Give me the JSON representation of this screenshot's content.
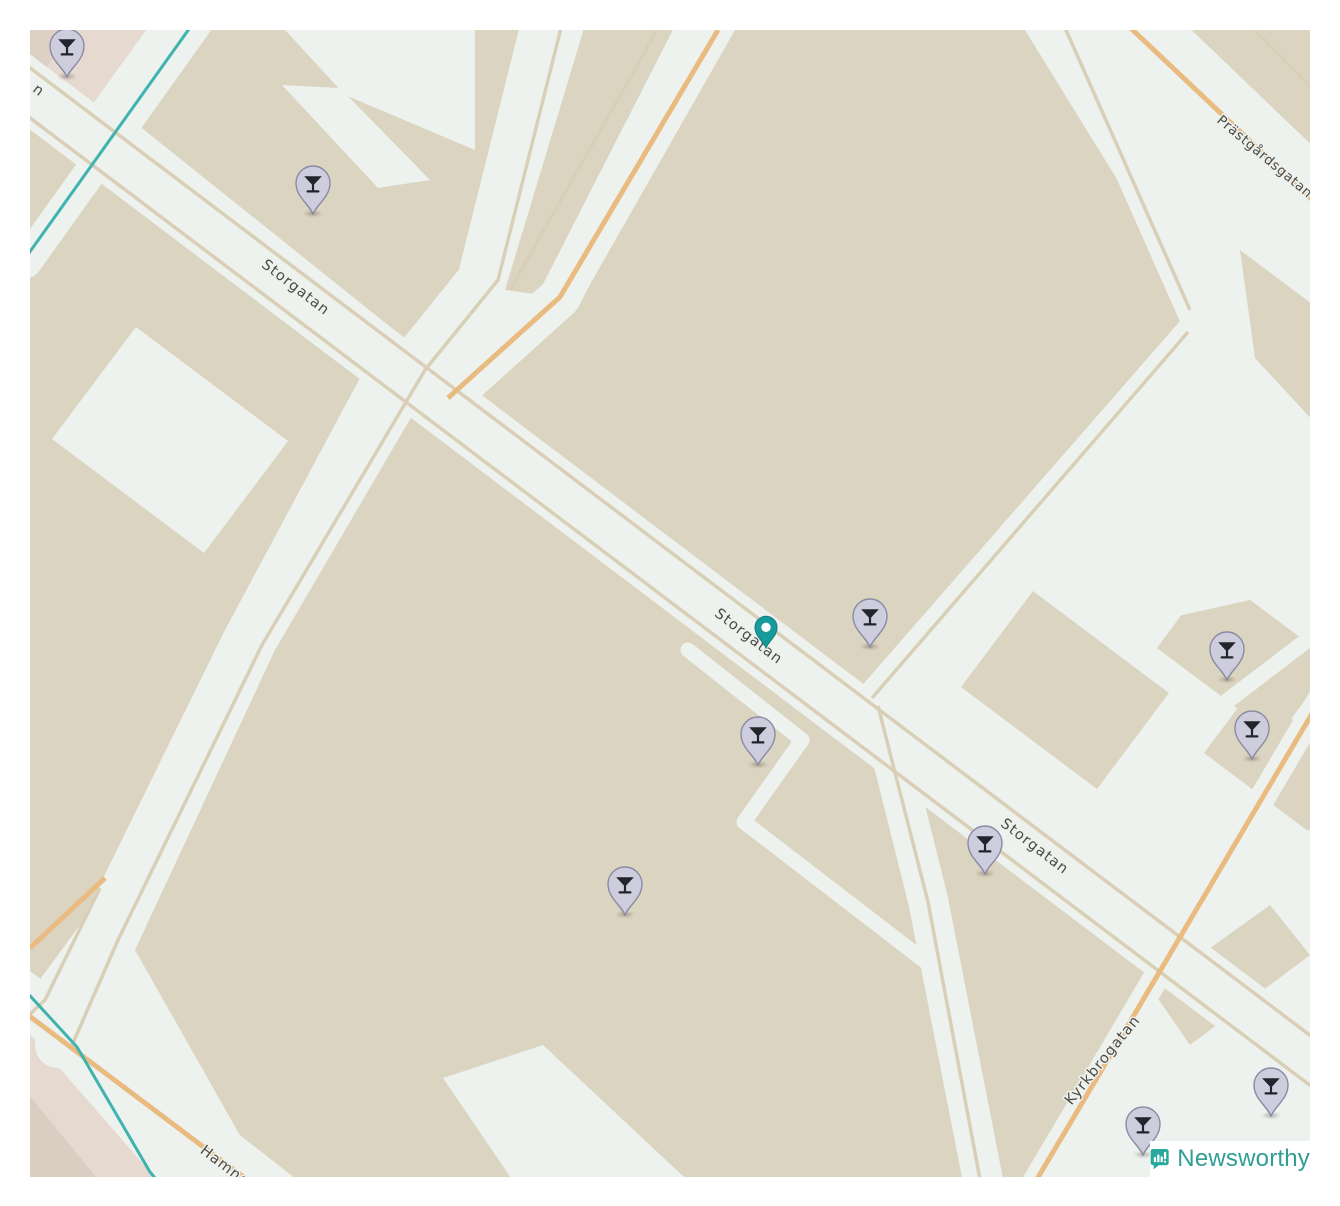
{
  "attribution": {
    "brand": "Newsworthy",
    "logo_icon": "bar-chart-speech-bubble-icon",
    "brand_color": "#2f9e95"
  },
  "map": {
    "street_labels": [
      {
        "name": "storgatan-northwest",
        "text": "Storgatan"
      },
      {
        "name": "storgatan-middle",
        "text": "Storgatan"
      },
      {
        "name": "storgatan-southeast",
        "text": "Storgatan"
      },
      {
        "name": "prastgardsgatan",
        "text": "Prästgårdsgatan"
      },
      {
        "name": "kyrkbrogatan",
        "text": "Kyrkbrogatan"
      },
      {
        "name": "hamngatan",
        "text": "Hamngatan"
      },
      {
        "name": "street-name-edge-fragment",
        "text": "n"
      }
    ],
    "markers": {
      "icon": "cocktail-glass-icon",
      "items": [
        {
          "x": 67,
          "y": 77,
          "kind": "venue"
        },
        {
          "x": 313,
          "y": 214,
          "kind": "venue"
        },
        {
          "x": 766,
          "y": 648,
          "kind": "selected"
        },
        {
          "x": 870,
          "y": 647,
          "kind": "venue"
        },
        {
          "x": 758,
          "y": 765,
          "kind": "venue"
        },
        {
          "x": 625,
          "y": 915,
          "kind": "venue"
        },
        {
          "x": 985,
          "y": 874,
          "kind": "venue"
        },
        {
          "x": 1227,
          "y": 680,
          "kind": "venue"
        },
        {
          "x": 1252,
          "y": 759,
          "kind": "venue"
        },
        {
          "x": 1143,
          "y": 1155,
          "kind": "venue"
        },
        {
          "x": 1271,
          "y": 1116,
          "kind": "venue"
        }
      ]
    },
    "colors": {
      "block_land": "#dbd4c0",
      "road_surface": "#edf2ee",
      "minor_road_line": "#d9cfb6",
      "tertiary_road": "#e9bb81",
      "waterway": "#3eb3ae",
      "label_text": "#4d4a45",
      "pin_fill": "#cdcdde",
      "selected_pin": "#189a9d",
      "retail_area": "#e6d9cf"
    }
  }
}
